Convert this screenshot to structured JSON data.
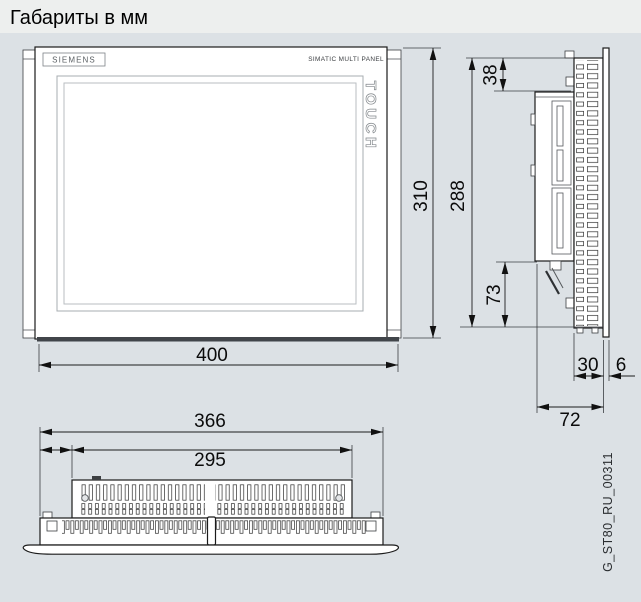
{
  "page": {
    "title": "Габариты в мм",
    "drawing_code": "G_ST80_RU_00311"
  },
  "front_view": {
    "brand": "SIEMENS",
    "product_label": "SIMATIC MULTI PANEL",
    "touch_label": "TOUCH",
    "dimensions": {
      "width": "400",
      "height": "310"
    }
  },
  "side_view": {
    "dimensions": {
      "mounting_height": "288",
      "top_inset": "38",
      "bottom_inset": "73",
      "vent_section_depth": "30",
      "front_bezel_thickness": "6",
      "mounting_depth": "72"
    }
  },
  "bottom_view": {
    "dimensions": {
      "overall_width": "366",
      "vent_body_width": "295"
    }
  }
}
